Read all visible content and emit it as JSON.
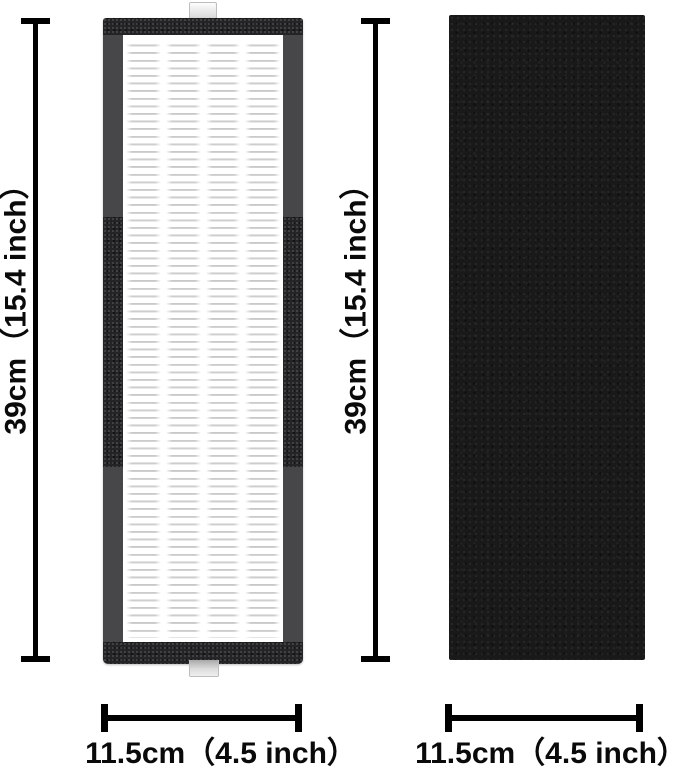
{
  "canvas": {
    "background": "#ffffff"
  },
  "colors": {
    "dimension_ink": "#000000",
    "hepa_frame_gray": "#47474a",
    "hepa_foam_dark": "#242426",
    "pleat_line": "#c5c5c5",
    "pleat_background": "#ffffff",
    "tab_gray": "#dcdcdc",
    "carbon_black": "#191919"
  },
  "left_figure": {
    "height_label": "39cm（15.4 inch）",
    "width_label": "11.5cm（4.5 inch）"
  },
  "right_figure": {
    "height_label": "39cm（15.4 inch）",
    "width_label": "11.5cm（4.5 inch）"
  }
}
